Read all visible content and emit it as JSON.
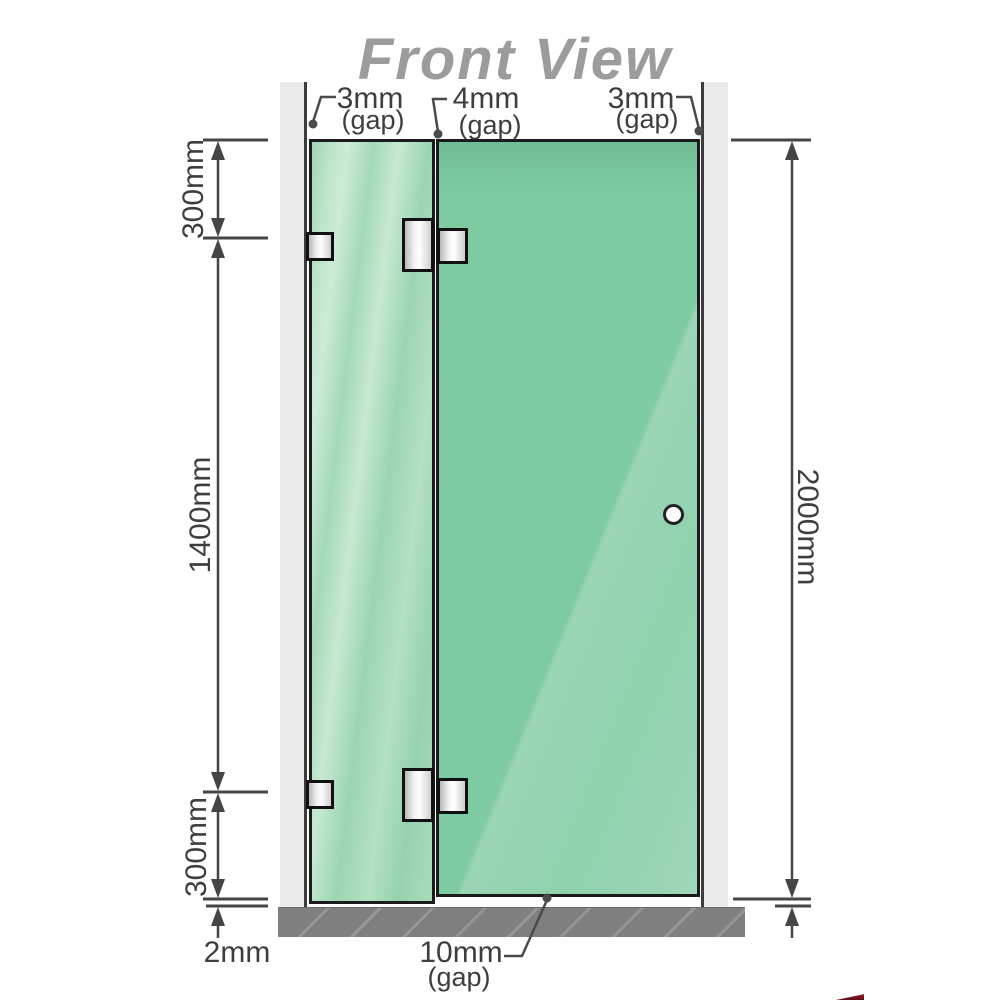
{
  "title": "Front View",
  "top_gaps": {
    "left": {
      "value": "3mm",
      "note": "(gap)"
    },
    "middle": {
      "value": "4mm",
      "note": "(gap)"
    },
    "right": {
      "value": "3mm",
      "note": "(gap)"
    }
  },
  "left_dimensions": {
    "top_segment": "300mm",
    "middle_segment": "1400mm",
    "bottom_segment": "300mm",
    "floor_gap": "2mm"
  },
  "right_dimension": {
    "total_height": "2000mm"
  },
  "bottom_gap": {
    "value": "10mm",
    "note": "(gap)"
  },
  "colors": {
    "glass_fixed_panel": "#a9dcbf",
    "glass_door_panel": "#7ecaa1",
    "wall_rail": "#ebebeb",
    "floor": "#7f7f7f",
    "dimension_line": "#454545",
    "title": "#9c9c9c",
    "hardware": "#e8e8e8"
  }
}
